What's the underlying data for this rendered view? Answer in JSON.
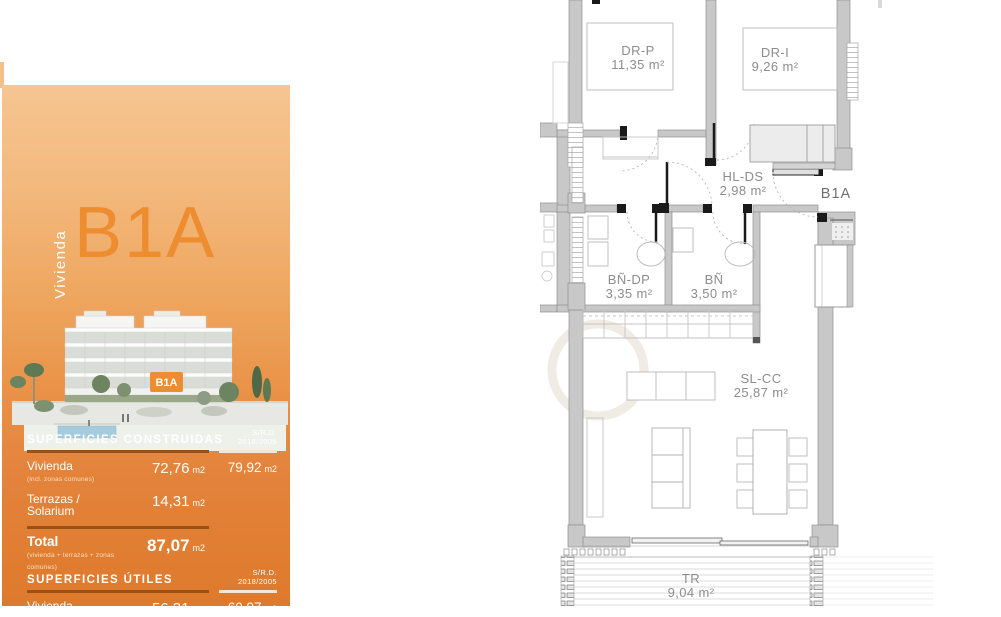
{
  "sidebar": {
    "kicker": "Vivienda",
    "title": "B1A",
    "accent_color": "#ee8c30",
    "panel_top_color": "#f6c591",
    "panel_bottom_color": "#de7a2c",
    "illustration": {
      "badge": "B1A"
    },
    "std_header": {
      "line1": "S/R.D.",
      "line2": "2018/2005"
    },
    "tables": [
      {
        "header": "SUPERFICIES CONSTRUIDAS",
        "rows": [
          {
            "label": "Vivienda",
            "sublabel": "(incl. zonas comunes)",
            "value": "72,76",
            "unit": "m2",
            "std_value": "79,92",
            "std_unit": "m2"
          },
          {
            "label": "Terrazas / Solarium",
            "value": "14,31",
            "unit": "m2"
          }
        ],
        "total": {
          "label": "Total",
          "sublabel": "(vivienda + terrazas + zonas comunes)",
          "value": "87,07",
          "unit": "m2"
        }
      },
      {
        "header": "SUPERFICIES ÚTILES",
        "rows": [
          {
            "label": "Vivienda",
            "value": "56,31",
            "unit": "m2",
            "std_value": "60,97",
            "std_unit": "m2"
          }
        ]
      }
    ]
  },
  "plan": {
    "unit_label": "B1A",
    "label_color": "#8d8d8d",
    "wall_color": "#c8c8c8",
    "rooms": [
      {
        "name": "DR-P",
        "area": "11,35 m²"
      },
      {
        "name": "DR-I",
        "area": "9,26 m²"
      },
      {
        "name": "HL-DS",
        "area": "2,98 m²"
      },
      {
        "name": "BÑ-DP",
        "area": "3,35 m²"
      },
      {
        "name": "BÑ",
        "area": "3,50 m²"
      },
      {
        "name": "SL-CC",
        "area": "25,87 m²"
      },
      {
        "name": "TR",
        "area": "9,04 m²"
      }
    ]
  }
}
